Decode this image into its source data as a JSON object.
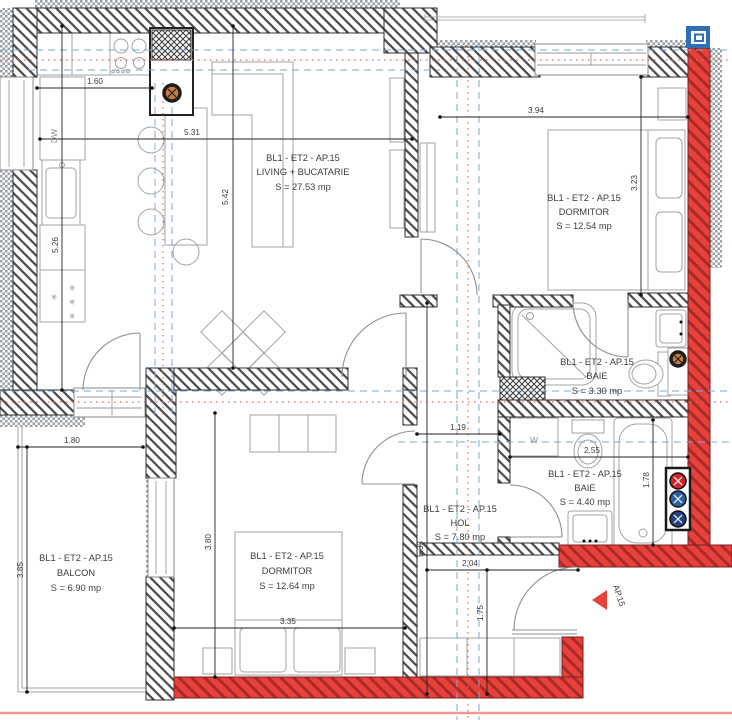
{
  "plan": {
    "title_code": "BL1 - ET2 - AP.15",
    "rooms": [
      {
        "id": "living",
        "code": "BL1 - ET2 - AP.15",
        "name": "LIVING + BUCATARIE",
        "area": "S = 27.53 mp"
      },
      {
        "id": "dormitor1",
        "code": "BL1 - ET2 - AP.15",
        "name": "DORMITOR",
        "area": "S = 12.54 mp"
      },
      {
        "id": "baie1",
        "code": "BL1 - ET2 - AP.15",
        "name": "BAIE",
        "area": "S = 3.30 mp"
      },
      {
        "id": "baie2",
        "code": "BL1 - ET2 - AP.15",
        "name": "BAIE",
        "area": "S = 4.40 mp"
      },
      {
        "id": "hol",
        "code": "BL1 - ET2 - AP.15",
        "name": "HOL",
        "area": "S = 7.80 mp"
      },
      {
        "id": "dormitor2",
        "code": "BL1 - ET2 - AP.15",
        "name": "DORMITOR",
        "area": "S = 12.64 mp"
      },
      {
        "id": "balcon",
        "code": "BL1 - ET2 - AP.15",
        "name": "BALCON",
        "area": "S = 6.90 mp"
      }
    ],
    "dims": {
      "k160": "1.60",
      "k531": "5.31",
      "k542": "5.42",
      "k526": "5.26",
      "k394": "3.94",
      "k323": "3.23",
      "k119": "1.19",
      "k255": "2.55",
      "k178": "1.78",
      "k180": "1.80",
      "k385": "3.85",
      "k380": "3.80",
      "k335": "3.35",
      "k533": "5.33",
      "k204": "2.04",
      "k175": "1.75"
    },
    "annotations": {
      "dishwasher": "DW",
      "washing_machine": "W",
      "entrance_label": "AP.15",
      "freezer_star": "✳"
    },
    "colors": {
      "wall_red": "#e8403a",
      "red_stripe": "#a82b27",
      "accent_blue": "#2f6fb5",
      "grid_blue": "#7da7d9",
      "grid_red": "#e06666",
      "marker_orange": "#c97c3c",
      "riser_red": "#cf2428",
      "riser_blue": "#2e5fa5",
      "riser_dark_blue": "#23417e"
    }
  }
}
